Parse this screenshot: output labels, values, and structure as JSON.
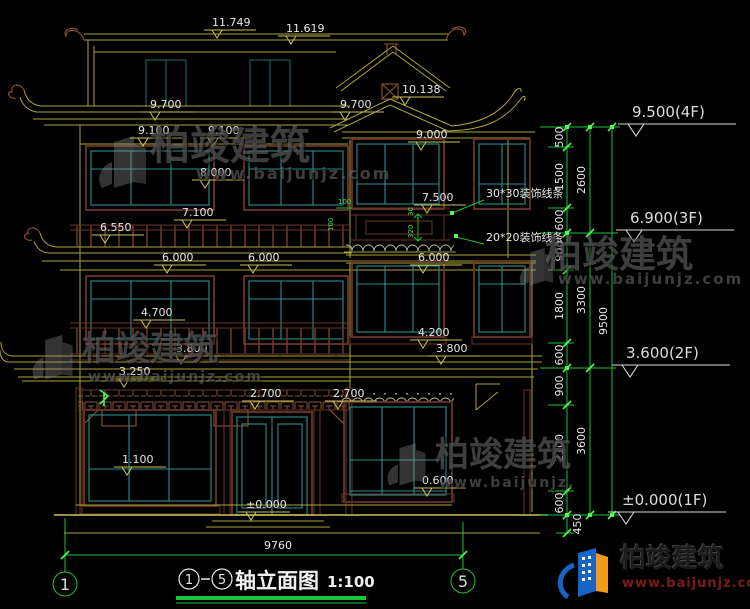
{
  "watermark": {
    "brand": "柏竣建筑",
    "url": "www.baijunjz.com"
  },
  "logo": {
    "brand": "柏竣建筑",
    "url": "www.baijunjz.com"
  },
  "top_marks": [
    "11.749",
    "11.619"
  ],
  "marks": [
    "9.700",
    "9.700",
    "10.138",
    "9.100",
    "9.100",
    "9.000",
    "8.000",
    "7.500",
    "7.100",
    "6.550",
    "6.000",
    "6.000",
    "6.000",
    "4.700",
    "4.200",
    "3.800",
    "3.800",
    "3.250",
    "2.700",
    "2.700",
    "1.100",
    "0.600",
    "±0.000"
  ],
  "floor_marks": [
    "9.500(4F)",
    "6.900(3F)",
    "3.600(2F)",
    "±0.000(1F)"
  ],
  "chain_inner": [
    "500",
    "1500",
    "600",
    "900",
    "1800",
    "600",
    "900",
    "2100",
    "600",
    "450"
  ],
  "chain_mid": [
    "2600",
    "3300",
    "3600"
  ],
  "chain_overall": "9500",
  "annotations": {
    "line30": "30*30装饰线条",
    "line20": "20*20装饰线条"
  },
  "detail_dims": [
    "100",
    "100",
    "30",
    "320"
  ],
  "bottom": {
    "overall_width": "9760",
    "axis_left": "1",
    "axis_right": "5",
    "title_axis_start": "1",
    "title_axis_end": "5",
    "title": "轴立面图",
    "scale": "1:100"
  }
}
